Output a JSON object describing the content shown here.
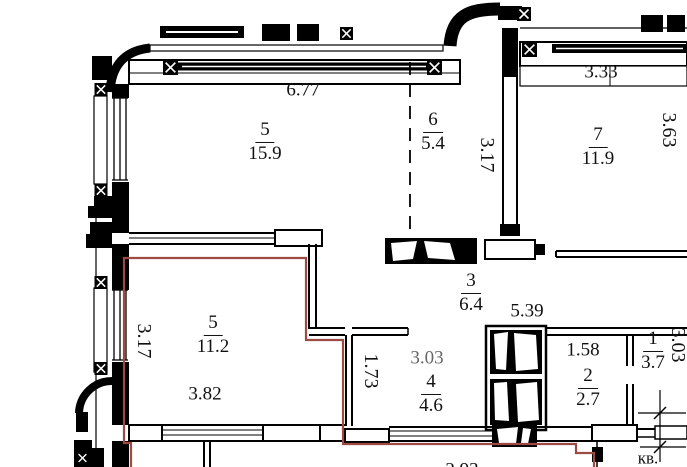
{
  "plan": {
    "title": "apartment floor plan fragment",
    "colors": {
      "wall": "#000000",
      "boundary": "#9c4a42",
      "dim_gray": "#666666"
    },
    "rooms": {
      "r5top": {
        "num": "5",
        "area": "15.9"
      },
      "r6": {
        "num": "6",
        "area": "5.4"
      },
      "r7": {
        "num": "7",
        "area": "11.9"
      },
      "r3": {
        "num": "3",
        "area": "6.4"
      },
      "r5bot": {
        "num": "5",
        "area": "11.2"
      },
      "r4": {
        "num": "4",
        "area": "4.6"
      },
      "r2": {
        "num": "2",
        "area": "2.7"
      },
      "r1": {
        "num": "1",
        "area": "3.7"
      }
    },
    "dims": {
      "top_width": "6.77",
      "r6_height": "3.17",
      "r7_width": "3.33",
      "r7_height": "3.63",
      "r3_width": "5.39",
      "r5bot_height": "3.17",
      "r5bot_width": "3.82",
      "r4_entry": "1.73",
      "r4_width": "3.03",
      "r2_width": "1.58",
      "r1_height": "3.03",
      "bottom_width": "2.93"
    },
    "labels": {
      "apartment": "кв."
    }
  }
}
